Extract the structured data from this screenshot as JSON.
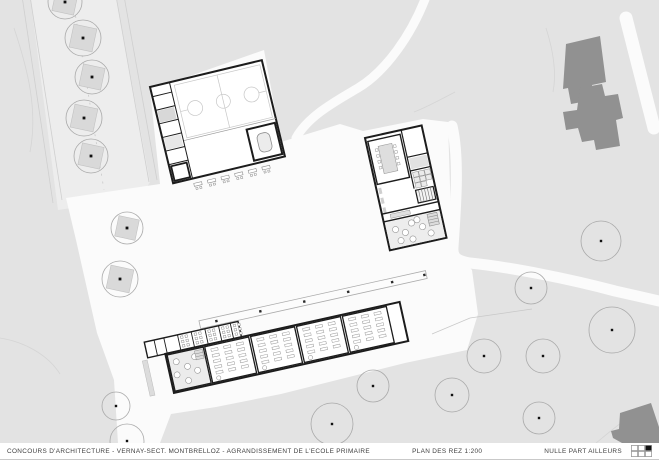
{
  "titlebar": {
    "project_title": "CONCOURS D'ARCHITECTURE   -   VERNAY-SECT. MONTBRELLOZ   -   AGRANDISSEMENT DE L'ECOLE PRIMAIRE",
    "plan_label": "PLAN DES REZ 1:200",
    "firm_name": "NULLE PART AILLEURS"
  },
  "colors": {
    "background": "#e3e3e3",
    "road": "#ededed",
    "plaza": "#fbfbfb",
    "existing_building": "#919191",
    "wall": "#1c1c1c",
    "furniture": "#979797",
    "tree_outline": "#a9a9a9",
    "planter_fill": "#d9d9d9",
    "court_line": "#c7c7c7"
  },
  "site": {
    "field_trees": [
      {
        "x": 601,
        "y": 241,
        "r": 20
      },
      {
        "x": 531,
        "y": 288,
        "r": 16
      },
      {
        "x": 612,
        "y": 330,
        "r": 23
      },
      {
        "x": 543,
        "y": 356,
        "r": 17
      },
      {
        "x": 484,
        "y": 356,
        "r": 17
      },
      {
        "x": 452,
        "y": 395,
        "r": 17
      },
      {
        "x": 539,
        "y": 418,
        "r": 16
      },
      {
        "x": 373,
        "y": 386,
        "r": 16
      },
      {
        "x": 332,
        "y": 424,
        "r": 21
      },
      {
        "x": 116,
        "y": 406,
        "r": 14
      },
      {
        "x": 127,
        "y": 441,
        "r": 17
      }
    ],
    "planter_trees": [
      {
        "x": 65,
        "y": 2,
        "r": 17
      },
      {
        "x": 83,
        "y": 38,
        "r": 18
      },
      {
        "x": 92,
        "y": 77,
        "r": 17
      },
      {
        "x": 84,
        "y": 118,
        "r": 18
      },
      {
        "x": 91,
        "y": 156,
        "r": 17
      },
      {
        "x": 127,
        "y": 228,
        "r": 16
      },
      {
        "x": 120,
        "y": 279,
        "r": 18
      }
    ],
    "gym_benches": {
      "count": 6,
      "x0": 20,
      "step": 14,
      "y": 104
    },
    "canopy_posts": [
      75,
      120,
      165,
      210,
      255,
      288
    ],
    "service_fixture_cells": [
      35,
      49,
      63,
      77,
      89
    ],
    "classrooms": {
      "count": 4,
      "x0": 58,
      "step": 47,
      "w": 45,
      "desk_rows": 5,
      "desk_cols": 3
    },
    "middle_tables": [
      [
        10,
        96
      ],
      [
        19,
        101
      ],
      [
        13,
        108
      ],
      [
        27,
        93
      ],
      [
        25,
        109
      ],
      [
        37,
        99
      ],
      [
        44,
        107
      ],
      [
        33,
        91
      ]
    ],
    "left_room_tables": [
      [
        27,
        18
      ],
      [
        37,
        25
      ],
      [
        25,
        31
      ],
      [
        35,
        39
      ],
      [
        46,
        31
      ],
      [
        46,
        17
      ]
    ]
  },
  "logo": {
    "rows": 2,
    "cols": 3,
    "filled_row": 0,
    "filled_col": 2
  }
}
